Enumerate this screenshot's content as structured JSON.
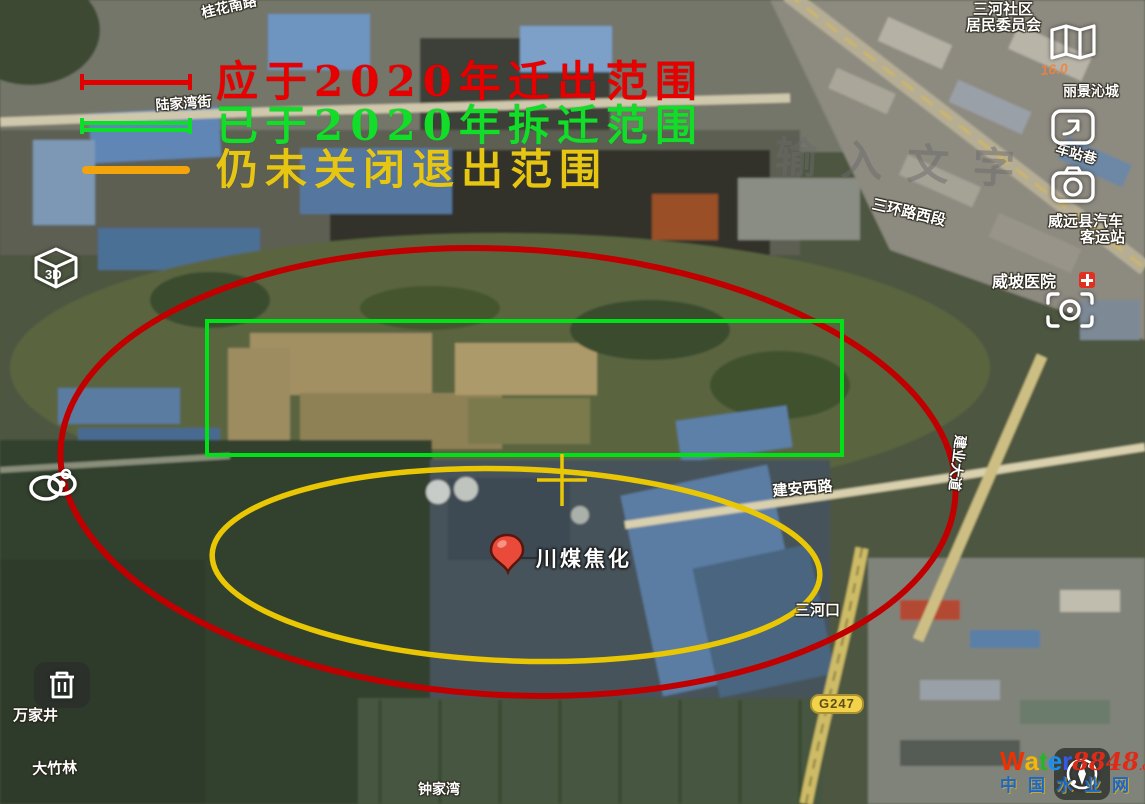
{
  "colors": {
    "annotation_red": "#c00000",
    "annotation_green": "#00e118",
    "annotation_yellow": "#e9c704",
    "legend_red": "#e00000",
    "legend_green": "#0cdf2a",
    "legend_orange": "#f2a40a",
    "legend_yellow_text": "#e6c613"
  },
  "legend": {
    "items": [
      {
        "label": "应于2020年迁出范围",
        "line_color": "#e00000",
        "text_color": "#e60000",
        "line_style": "ticks"
      },
      {
        "label": "已于2020年拆迁范围",
        "line_color": "#0cdf2a",
        "text_color": "#12dd28",
        "line_style": "double"
      },
      {
        "label": "仍未关闭退出范围",
        "line_color": "#f2a40a",
        "text_color": "#e6c613",
        "line_style": "plain"
      }
    ]
  },
  "map_labels": [
    {
      "text": "桂花南路",
      "x": 200,
      "y": 6,
      "rot": -13,
      "size": 14
    },
    {
      "text": "陆家湾街",
      "x": 155,
      "y": 98,
      "rot": -4,
      "size": 14
    },
    {
      "text": "三河社区",
      "x": 973,
      "y": 2,
      "rot": 0,
      "size": 15
    },
    {
      "text": "居民委员会",
      "x": 966,
      "y": 18,
      "rot": 0,
      "size": 15
    },
    {
      "text": "16.0",
      "x": 1040,
      "y": 63,
      "rot": -4,
      "size": 14,
      "variant": "faint"
    },
    {
      "text": "丽景沁城",
      "x": 1063,
      "y": 84,
      "rot": 0,
      "size": 14
    },
    {
      "text": "车站巷",
      "x": 1058,
      "y": 141,
      "rot": 16,
      "size": 14
    },
    {
      "text": "威远县汽车",
      "x": 1048,
      "y": 214,
      "rot": 0,
      "size": 15
    },
    {
      "text": "客运站",
      "x": 1080,
      "y": 230,
      "rot": 0,
      "size": 15
    },
    {
      "text": "威坡医院",
      "x": 992,
      "y": 274,
      "rot": 0,
      "size": 16
    },
    {
      "text": "三环路西段",
      "x": 874,
      "y": 197,
      "rot": 13,
      "size": 15
    },
    {
      "text": "建安西路",
      "x": 772,
      "y": 484,
      "rot": -5,
      "size": 15
    },
    {
      "text": "建业大道",
      "x": 968,
      "y": 436,
      "rot": 97,
      "size": 14
    },
    {
      "text": "三河口",
      "x": 795,
      "y": 603,
      "rot": 0,
      "size": 15
    },
    {
      "text": "万家井",
      "x": 13,
      "y": 708,
      "rot": 0,
      "size": 15
    },
    {
      "text": "大竹林",
      "x": 32,
      "y": 762,
      "rot": -2,
      "size": 15
    },
    {
      "text": "钟家湾",
      "x": 418,
      "y": 782,
      "rot": 0,
      "size": 14
    },
    {
      "text": "川煤焦化",
      "x": 536,
      "y": 548,
      "rot": 0,
      "size": 21,
      "variant": "poi"
    }
  ],
  "controls": {
    "cube_3d_label": "3D",
    "highway_shield": "G247"
  },
  "watermarks": {
    "placeholder_text": "输入文字",
    "logo_word_letters": [
      {
        "ch": "W",
        "color": "#f03000"
      },
      {
        "ch": "a",
        "color": "#f5b800"
      },
      {
        "ch": "t",
        "color": "#28b428"
      },
      {
        "ch": "e",
        "color": "#1890f0"
      },
      {
        "ch": "r",
        "color": "#3858e8"
      }
    ],
    "logo_number": "8848",
    "logo_suffix": ".com",
    "logo_line2": "中国水业网"
  }
}
